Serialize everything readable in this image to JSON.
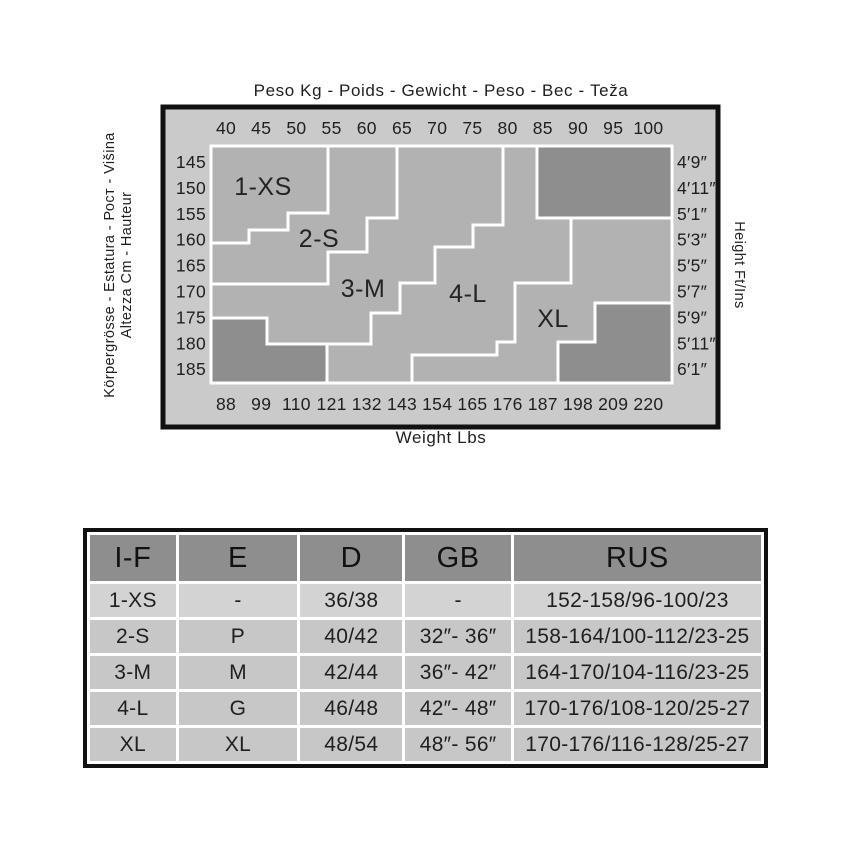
{
  "chart_data": {
    "type": "size-zone-grid",
    "title": "Peso Kg - Poids - Gewicht - Peso - Вес - Teža",
    "bottom_axis_label": "Weight Lbs",
    "left_axis_label_inner": "Altezza Cm - Hauteur",
    "left_axis_label_outer": "Körpergrösse - Estatura - Рост - Višina",
    "right_axis_label": "Height Ft/Ins",
    "weight_kg_ticks": [
      "40",
      "45",
      "50",
      "55",
      "60",
      "65",
      "70",
      "75",
      "80",
      "85",
      "90",
      "95",
      "100"
    ],
    "weight_lbs_ticks": [
      "88",
      "99",
      "110",
      "121",
      "132",
      "143",
      "154",
      "165",
      "176",
      "187",
      "198",
      "209",
      "220"
    ],
    "height_cm_ticks": [
      "145",
      "150",
      "155",
      "160",
      "165",
      "170",
      "175",
      "180",
      "185"
    ],
    "height_ftin_ticks": [
      "4′9″",
      "4′11″",
      "5′1″",
      "5′3″",
      "5′5″",
      "5′7″",
      "5′9″",
      "5′11″",
      "6′1″"
    ],
    "zones": [
      {
        "label": "1-XS",
        "label_xy": [
          263,
          186
        ],
        "polygon": [
          [
            211,
            146
          ],
          [
            328,
            146
          ],
          [
            328,
            213
          ],
          [
            288,
            213
          ],
          [
            288,
            230
          ],
          [
            249,
            230
          ],
          [
            249,
            243
          ],
          [
            211,
            243
          ]
        ]
      },
      {
        "label": "2-S",
        "label_xy": [
          319,
          238
        ],
        "polygon": [
          [
            328,
            146
          ],
          [
            397,
            146
          ],
          [
            397,
            218
          ],
          [
            367,
            218
          ],
          [
            367,
            252
          ],
          [
            328,
            252
          ],
          [
            328,
            284
          ],
          [
            211,
            284
          ],
          [
            211,
            243
          ],
          [
            249,
            243
          ],
          [
            249,
            230
          ],
          [
            288,
            230
          ],
          [
            288,
            213
          ],
          [
            328,
            213
          ]
        ]
      },
      {
        "label": "3-M",
        "label_xy": [
          363,
          288
        ],
        "polygon": [
          [
            397,
            146
          ],
          [
            503,
            146
          ],
          [
            503,
            225
          ],
          [
            473,
            225
          ],
          [
            473,
            247
          ],
          [
            435,
            247
          ],
          [
            435,
            283
          ],
          [
            400,
            283
          ],
          [
            400,
            313
          ],
          [
            371,
            313
          ],
          [
            371,
            344
          ],
          [
            267,
            344
          ],
          [
            267,
            318
          ],
          [
            211,
            318
          ],
          [
            211,
            284
          ],
          [
            328,
            284
          ],
          [
            328,
            252
          ],
          [
            367,
            252
          ],
          [
            367,
            218
          ],
          [
            397,
            218
          ]
        ]
      },
      {
        "label": "4-L",
        "label_xy": [
          468,
          293
        ],
        "polygon": [
          [
            503,
            146
          ],
          [
            537,
            146
          ],
          [
            537,
            218
          ],
          [
            571,
            218
          ],
          [
            571,
            283
          ],
          [
            515,
            283
          ],
          [
            515,
            342
          ],
          [
            497,
            342
          ],
          [
            497,
            355
          ],
          [
            412,
            355
          ],
          [
            412,
            383
          ],
          [
            327,
            383
          ],
          [
            327,
            344
          ],
          [
            371,
            344
          ],
          [
            371,
            313
          ],
          [
            400,
            313
          ],
          [
            400,
            283
          ],
          [
            435,
            283
          ],
          [
            435,
            247
          ],
          [
            473,
            247
          ],
          [
            473,
            225
          ],
          [
            503,
            225
          ]
        ]
      },
      {
        "label": "XL",
        "label_xy": [
          553,
          318
        ],
        "polygon": [
          [
            571,
            218
          ],
          [
            672,
            218
          ],
          [
            672,
            303
          ],
          [
            595,
            303
          ],
          [
            595,
            342
          ],
          [
            558,
            342
          ],
          [
            558,
            383
          ],
          [
            412,
            383
          ],
          [
            412,
            355
          ],
          [
            497,
            355
          ],
          [
            497,
            342
          ],
          [
            515,
            342
          ],
          [
            515,
            283
          ],
          [
            571,
            283
          ]
        ]
      }
    ],
    "shaded_regions": [
      {
        "name": "top-right",
        "polygon": [
          [
            537,
            146
          ],
          [
            672,
            146
          ],
          [
            672,
            218
          ],
          [
            537,
            218
          ]
        ]
      },
      {
        "name": "bottom-left",
        "polygon": [
          [
            211,
            318
          ],
          [
            267,
            318
          ],
          [
            267,
            344
          ],
          [
            327,
            344
          ],
          [
            327,
            383
          ],
          [
            211,
            383
          ]
        ]
      },
      {
        "name": "bottom-right",
        "polygon": [
          [
            595,
            303
          ],
          [
            672,
            303
          ],
          [
            672,
            383
          ],
          [
            558,
            383
          ],
          [
            558,
            342
          ],
          [
            595,
            342
          ]
        ]
      }
    ],
    "colors": {
      "band": "#cacaca",
      "zone_fill": "#b2b2b2",
      "shaded_fill": "#8e8e8e",
      "boundary_line": "#ffffff",
      "frame": "#111111",
      "text": "#1f1f1f"
    },
    "legend_position": "none",
    "grid": "off"
  },
  "size_table": {
    "headers": [
      "I-F",
      "E",
      "D",
      "GB",
      "RUS"
    ],
    "rows": [
      [
        "1-XS",
        "-",
        "36/38",
        "-",
        "152-158/96-100/23"
      ],
      [
        "2-S",
        "P",
        "40/42",
        "32″- 36″",
        "158-164/100-112/23-25"
      ],
      [
        "3-M",
        "M",
        "42/44",
        "36″- 42″",
        "164-170/104-116/23-25"
      ],
      [
        "4-L",
        "G",
        "46/48",
        "42″- 48″",
        "170-176/108-120/25-27"
      ],
      [
        "XL",
        "XL",
        "48/54",
        "48″- 56″",
        "170-176/116-128/25-27"
      ]
    ]
  }
}
